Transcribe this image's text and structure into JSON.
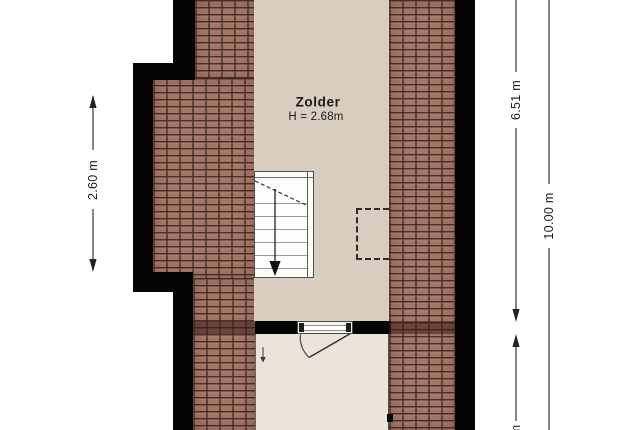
{
  "room": {
    "name": "Zolder",
    "height_label": "H = 2.68m"
  },
  "dimensions": {
    "left_wall": "2.60 m",
    "right_upper": "6.51 m",
    "right_lower_partial": "m",
    "right_total": "10.00 m"
  },
  "icons": {
    "stair_direction_arrow": "▼",
    "room_direction_arrow": "▼",
    "door_swing": "quarter-arc"
  },
  "colors": {
    "roof_tiles": "#a47668",
    "tile_joints": "#4a332a",
    "attic_floor": "#d9cdc0",
    "lower_room_floor": "#eae4db",
    "walls": "#050505",
    "background": "#ffffff",
    "dimension_text": "#1b1b1b"
  }
}
